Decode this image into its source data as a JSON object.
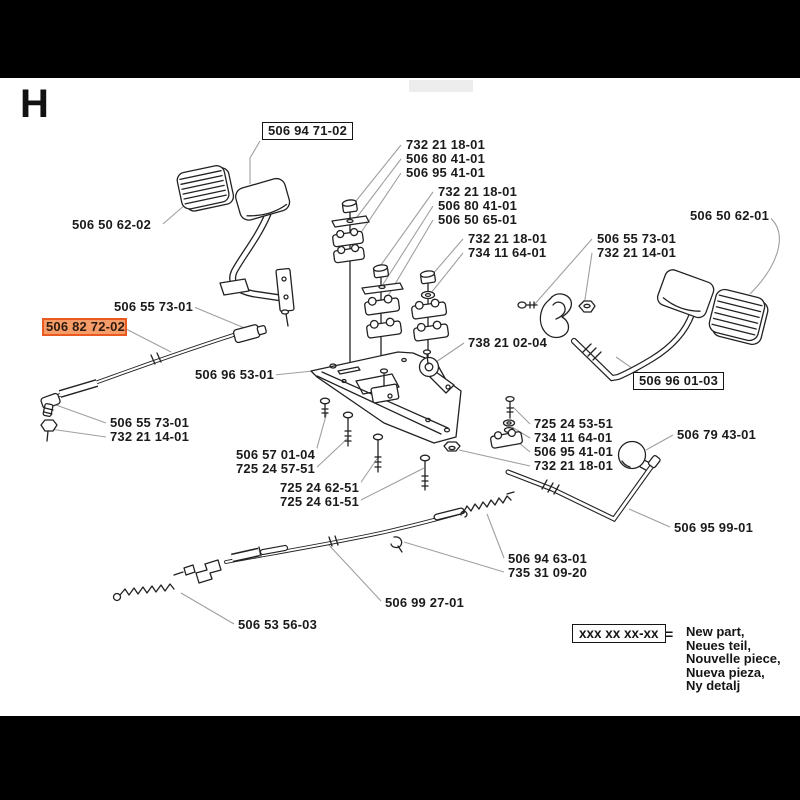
{
  "header": {
    "section_letter": "H"
  },
  "callouts": [
    {
      "text": "506 94 71-02",
      "variant": "boxed"
    },
    {
      "text": "732 21 18-01"
    },
    {
      "text": "506 80 41-01"
    },
    {
      "text": "506 95 41-01"
    },
    {
      "text": "732 21 18-01"
    },
    {
      "text": "506 80 41-01"
    },
    {
      "text": "506 50 65-01"
    },
    {
      "text": "732 21 18-01"
    },
    {
      "text": "734 11 64-01"
    },
    {
      "text": "506 55 73-01"
    },
    {
      "text": "732 21 14-01"
    },
    {
      "text": "506 50 62-01"
    },
    {
      "text": "506 50 62-02"
    },
    {
      "text": "506 55 73-01"
    },
    {
      "text": "506 82 72-02",
      "variant": "highlight"
    },
    {
      "text": "506 96 53-01"
    },
    {
      "text": "738 21 02-04"
    },
    {
      "text": "506 96 01-03",
      "variant": "boxed"
    },
    {
      "text": "506 55 73-01"
    },
    {
      "text": "732 21 14-01"
    },
    {
      "text": "506 57 01-04"
    },
    {
      "text": "725 24 57-51"
    },
    {
      "text": "725 24 62-51"
    },
    {
      "text": "725 24 61-51"
    },
    {
      "text": "725 24 53-51"
    },
    {
      "text": "734 11 64-01"
    },
    {
      "text": "506 95 41-01"
    },
    {
      "text": "732 21 18-01"
    },
    {
      "text": "506 79 43-01"
    },
    {
      "text": "506 95 99-01"
    },
    {
      "text": "506 94 63-01"
    },
    {
      "text": "735 31 09-20"
    },
    {
      "text": "506 99 27-01"
    },
    {
      "text": "506 53 56-03"
    }
  ],
  "legend": {
    "pattern": "xxx xx xx-xx",
    "equals": "=",
    "lines": [
      "New part,",
      "Neues teil,",
      "Nouvelle piece,",
      "Nueva pieza,",
      "Ny detalj"
    ]
  },
  "colors": {
    "highlight_border": "#ea5a20",
    "highlight_fill": "#f59c68",
    "artwork_line": "#222222",
    "leader_line": "#9f9f9f",
    "page_background": "#ffffff",
    "frame_bar": "#000000"
  }
}
